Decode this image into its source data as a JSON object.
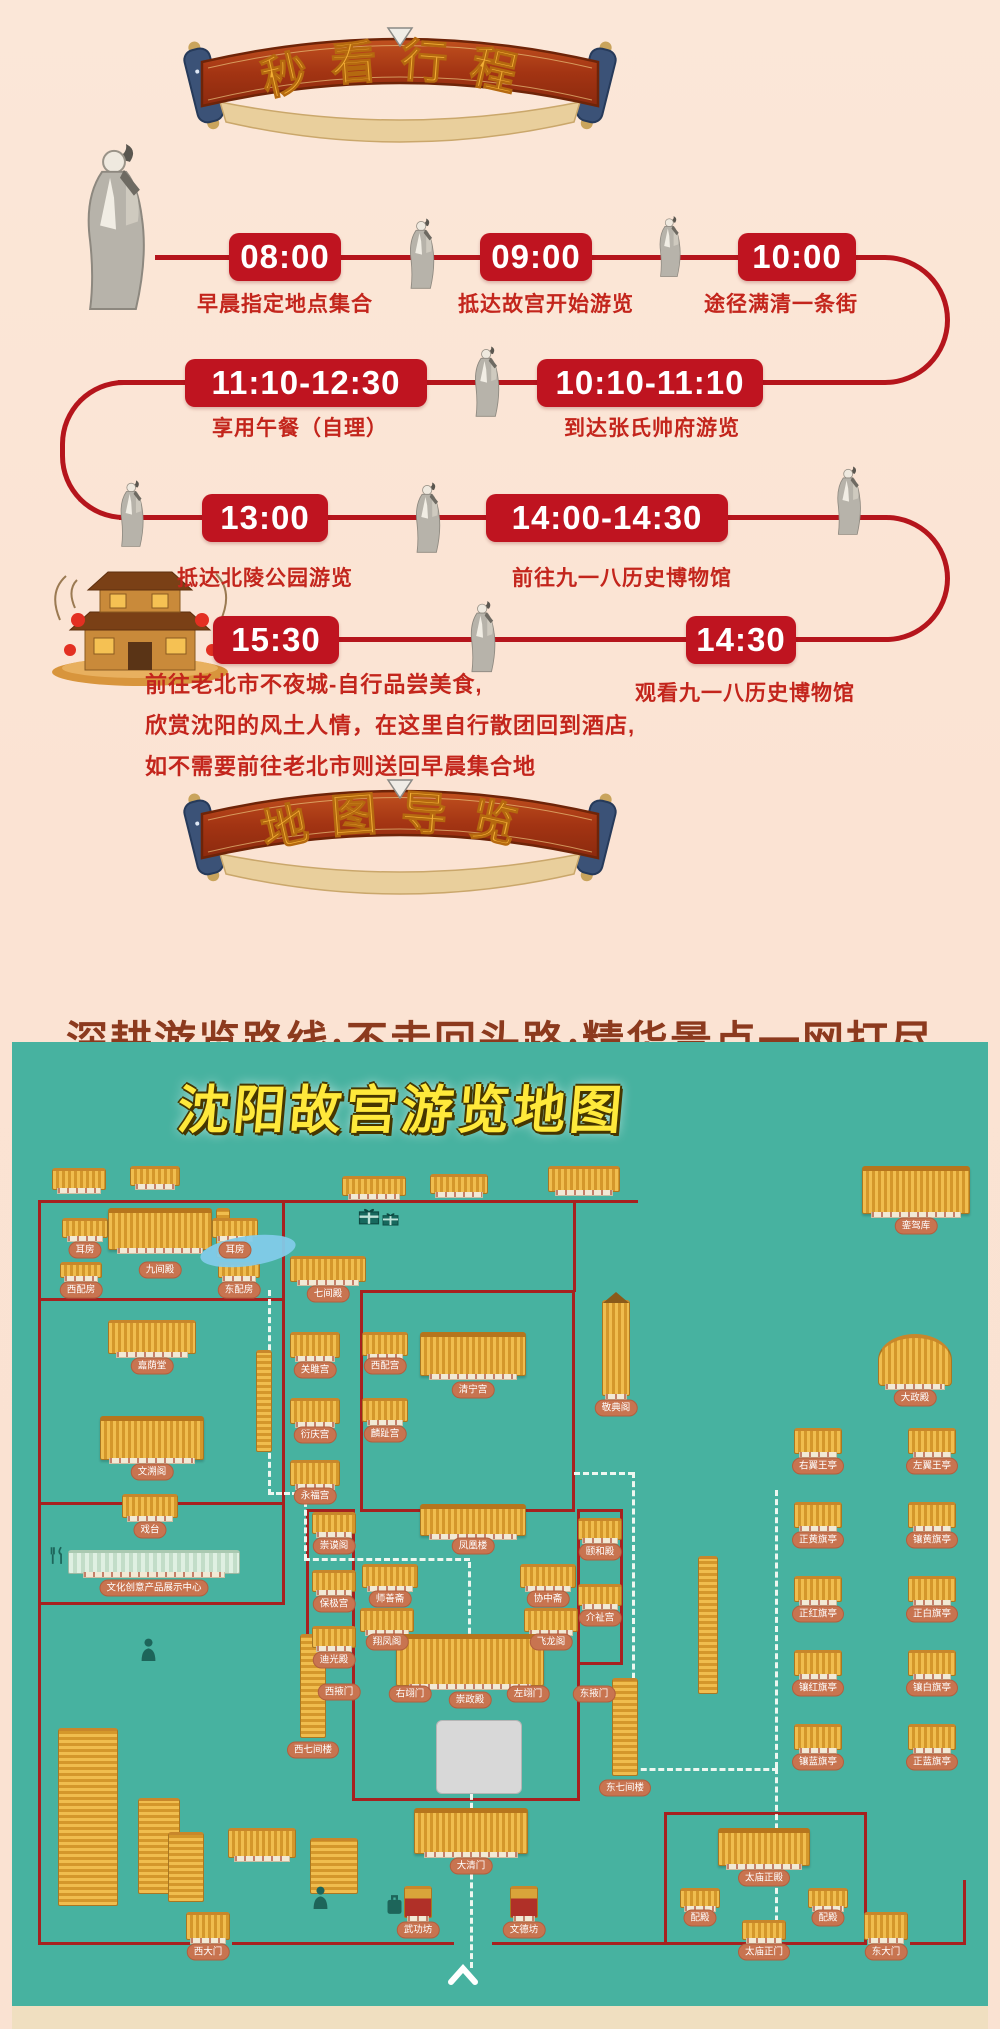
{
  "banners": {
    "itinerary": "秒看行程",
    "map": "地图导览"
  },
  "colors": {
    "page_bg": "#fbe7d8",
    "timeline_red": "#bf1420",
    "desc_red": "#c3251c",
    "tagline_brown": "#8c3a1e",
    "map_teal": "#47b2a0",
    "wall_red": "#a6211f",
    "label_pill": "#c87450",
    "roof_gold": "#e9b54a",
    "title_yellow": "#ffe93b"
  },
  "timeline": {
    "rows": [
      {
        "y": 257,
        "dy": 303,
        "stops": [
          {
            "time": "08:00",
            "cx": 285,
            "w": 112,
            "desc": "早晨指定地点集合",
            "dx": 285
          },
          {
            "time": "09:00",
            "cx": 536,
            "w": 112,
            "desc": "抵达故宫开始游览",
            "dx": 546
          },
          {
            "time": "10:00",
            "cx": 797,
            "w": 118,
            "desc": "途径满清一条街",
            "dx": 781
          }
        ]
      },
      {
        "y": 383,
        "dy": 427,
        "stops": [
          {
            "time": "11:10-12:30",
            "cx": 306,
            "w": 242,
            "desc": "享用午餐（自理）",
            "dx": 300
          },
          {
            "time": "10:10-11:10",
            "cx": 650,
            "w": 226,
            "desc": "到达张氏帅府游览",
            "dx": 652
          }
        ]
      },
      {
        "y": 518,
        "dy": 577,
        "stops": [
          {
            "time": "13:00",
            "cx": 265,
            "w": 126,
            "desc": "抵达北陵公园游览",
            "dx": 265
          },
          {
            "time": "14:00-14:30",
            "cx": 607,
            "w": 242,
            "desc": "前往九一八历史博物馆",
            "dx": 622
          }
        ]
      },
      {
        "y": 640,
        "dy": 692,
        "stops": [
          {
            "time": "15:30",
            "cx": 276,
            "w": 126,
            "desc": "",
            "dx": 0
          },
          {
            "time": "14:30",
            "cx": 741,
            "w": 110,
            "desc": "观看九一八历史博物馆",
            "dx": 745
          }
        ]
      }
    ],
    "final_note_lines": "前往老北市不夜城-自行品尝美食,\n欣赏沈阳的风土人情，在这里自行散团回到酒店,\n如不需要前往老北市则送回早晨集合地"
  },
  "tagline": "深耕游览路线·不走回头路·精华景点一网打尽",
  "map": {
    "title": "沈阳故宫游览地图",
    "walls": [
      [
        26,
        158,
        600,
        3
      ],
      [
        26,
        158,
        3,
        745
      ],
      [
        270,
        158,
        3,
        404
      ],
      [
        26,
        256,
        247,
        3
      ],
      [
        26,
        460,
        247,
        3
      ],
      [
        26,
        560,
        247,
        3
      ],
      [
        348,
        248,
        215,
        3
      ],
      [
        348,
        248,
        3,
        222
      ],
      [
        560,
        248,
        3,
        222
      ],
      [
        348,
        467,
        215,
        3
      ],
      [
        340,
        467,
        3,
        292
      ],
      [
        565,
        467,
        3,
        292
      ],
      [
        340,
        756,
        228,
        3
      ],
      [
        294,
        467,
        49,
        3
      ],
      [
        294,
        467,
        3,
        156
      ],
      [
        294,
        620,
        49,
        3
      ],
      [
        565,
        467,
        46,
        3
      ],
      [
        608,
        467,
        3,
        156
      ],
      [
        565,
        620,
        46,
        3
      ],
      [
        561,
        158,
        3,
        92
      ],
      [
        652,
        770,
        3,
        133
      ],
      [
        852,
        770,
        3,
        133
      ],
      [
        652,
        770,
        203,
        3
      ],
      [
        26,
        900,
        152,
        3
      ],
      [
        220,
        900,
        222,
        3
      ],
      [
        480,
        900,
        174,
        3
      ],
      [
        652,
        900,
        203,
        3
      ],
      [
        898,
        900,
        56,
        3
      ],
      [
        951,
        838,
        3,
        65
      ]
    ],
    "paths": [
      [
        256,
        248,
        "v",
        205
      ],
      [
        256,
        450,
        "h",
        38
      ],
      [
        292,
        450,
        "v",
        68
      ],
      [
        292,
        516,
        "h",
        166
      ],
      [
        456,
        520,
        "v",
        100
      ],
      [
        458,
        690,
        "v",
        236
      ],
      [
        562,
        430,
        "h",
        60
      ],
      [
        620,
        430,
        "v",
        298
      ],
      [
        620,
        726,
        "h",
        146
      ],
      [
        763,
        448,
        "v",
        278
      ],
      [
        763,
        726,
        "v",
        172
      ]
    ],
    "buildings": [
      {
        "x": 40,
        "y": 126,
        "w": 54,
        "h": 22
      },
      {
        "x": 118,
        "y": 124,
        "w": 50,
        "h": 20
      },
      {
        "x": 330,
        "y": 134,
        "w": 64,
        "h": 20
      },
      {
        "x": 418,
        "y": 132,
        "w": 58,
        "h": 20
      },
      {
        "x": 536,
        "y": 124,
        "w": 72,
        "h": 26
      },
      {
        "x": 204,
        "y": 166,
        "w": 14,
        "h": 50,
        "t": "vlong"
      },
      {
        "x": 244,
        "y": 308,
        "w": 16,
        "h": 102,
        "t": "vlong"
      },
      {
        "x": 50,
        "y": 176,
        "w": 46,
        "h": 20,
        "l": "耳房",
        "ly": 208
      },
      {
        "x": 96,
        "y": 166,
        "w": 104,
        "h": 42,
        "t": "big",
        "l": "九间殿",
        "ly": 228
      },
      {
        "x": 200,
        "y": 176,
        "w": 46,
        "h": 20,
        "l": "耳房",
        "ly": 208
      },
      {
        "x": 48,
        "y": 220,
        "w": 42,
        "h": 16,
        "l": "西配房",
        "ly": 248
      },
      {
        "x": 206,
        "y": 220,
        "w": 42,
        "h": 16,
        "l": "东配房",
        "ly": 248
      },
      {
        "x": 96,
        "y": 278,
        "w": 88,
        "h": 34,
        "l": "嘉荫堂"
      },
      {
        "x": 88,
        "y": 374,
        "w": 104,
        "h": 44,
        "t": "big",
        "l": "文溯阁"
      },
      {
        "x": 110,
        "y": 452,
        "w": 56,
        "h": 24,
        "l": "戏台"
      },
      {
        "x": 56,
        "y": 508,
        "w": 172,
        "h": 24,
        "t": "pale",
        "l": "文化创意产品展示中心",
        "ly": 546
      },
      {
        "x": 288,
        "y": 592,
        "w": 26,
        "h": 104,
        "t": "vlong",
        "l": "西七间楼",
        "ly": 708
      },
      {
        "x": 300,
        "y": 470,
        "w": 44,
        "h": 22,
        "l": "崇谟阁"
      },
      {
        "x": 300,
        "y": 528,
        "w": 44,
        "h": 22,
        "l": "保极宫"
      },
      {
        "x": 300,
        "y": 584,
        "w": 44,
        "h": 22,
        "l": "迪光殿"
      },
      {
        "l": "西掖门",
        "lx": 327,
        "ly": 650
      },
      {
        "x": 278,
        "y": 214,
        "w": 76,
        "h": 26,
        "l": "七间殿",
        "ly": 252
      },
      {
        "x": 278,
        "y": 290,
        "w": 50,
        "h": 26,
        "l": "关雎宫",
        "ly": 328
      },
      {
        "x": 350,
        "y": 290,
        "w": 46,
        "h": 24,
        "l": "西配宫",
        "ly": 324
      },
      {
        "x": 408,
        "y": 290,
        "w": 106,
        "h": 44,
        "t": "big",
        "l": "清宁宫",
        "ly": 348
      },
      {
        "x": 278,
        "y": 356,
        "w": 50,
        "h": 26,
        "l": "衍庆宫",
        "ly": 393
      },
      {
        "x": 350,
        "y": 356,
        "w": 46,
        "h": 24,
        "l": "麟趾宫",
        "ly": 392
      },
      {
        "x": 278,
        "y": 418,
        "w": 50,
        "h": 26,
        "l": "永福宫",
        "ly": 454
      },
      {
        "x": 408,
        "y": 462,
        "w": 106,
        "h": 32,
        "t": "big",
        "l": "凤凰楼",
        "ly": 504
      },
      {
        "x": 350,
        "y": 522,
        "w": 56,
        "h": 24,
        "l": "师善斋",
        "ly": 557
      },
      {
        "x": 508,
        "y": 522,
        "w": 56,
        "h": 24,
        "l": "协中斋",
        "ly": 557
      },
      {
        "x": 348,
        "y": 566,
        "w": 54,
        "h": 24,
        "l": "翔凤阁",
        "ly": 600
      },
      {
        "x": 512,
        "y": 566,
        "w": 54,
        "h": 24,
        "l": "飞龙阁",
        "ly": 600
      },
      {
        "x": 384,
        "y": 592,
        "w": 148,
        "h": 52,
        "t": "big",
        "l": "崇政殿",
        "ly": 658
      },
      {
        "l": "右翊门",
        "lx": 398,
        "ly": 652
      },
      {
        "l": "左翊门",
        "lx": 516,
        "ly": 652
      },
      {
        "l": "东掖门",
        "lx": 582,
        "ly": 652
      },
      {
        "x": 424,
        "y": 678,
        "w": 86,
        "h": 74,
        "t": "plaza"
      },
      {
        "x": 402,
        "y": 766,
        "w": 114,
        "h": 46,
        "t": "big",
        "l": "大清门",
        "ly": 824
      },
      {
        "x": 392,
        "y": 844,
        "w": 28,
        "h": 32,
        "t": "paifang",
        "l": "武功坊",
        "ly": 888
      },
      {
        "x": 498,
        "y": 844,
        "w": 28,
        "h": 32,
        "t": "paifang",
        "l": "文德坊",
        "ly": 888
      },
      {
        "x": 590,
        "y": 258,
        "w": 28,
        "h": 96,
        "t": "tower",
        "l": "敬典阁",
        "ly": 366
      },
      {
        "x": 566,
        "y": 476,
        "w": 44,
        "h": 22,
        "l": "颐和殿",
        "ly": 510
      },
      {
        "x": 566,
        "y": 542,
        "w": 44,
        "h": 22,
        "l": "介祉宫",
        "ly": 576
      },
      {
        "x": 600,
        "y": 636,
        "w": 26,
        "h": 98,
        "t": "vlong",
        "l": "东七间楼",
        "ly": 746
      },
      {
        "x": 850,
        "y": 124,
        "w": 108,
        "h": 48,
        "t": "big",
        "l": "銮驾库",
        "ly": 184
      },
      {
        "x": 866,
        "y": 292,
        "w": 74,
        "h": 52,
        "t": "dazheng",
        "l": "大政殿",
        "ly": 356
      },
      {
        "x": 782,
        "y": 386,
        "w": 48,
        "h": 26,
        "l": "右翼王亭",
        "ly": 424
      },
      {
        "x": 896,
        "y": 386,
        "w": 48,
        "h": 26,
        "l": "左翼王亭",
        "ly": 424
      },
      {
        "x": 782,
        "y": 460,
        "w": 48,
        "h": 26,
        "l": "正黄旗亭",
        "ly": 498
      },
      {
        "x": 896,
        "y": 460,
        "w": 48,
        "h": 26,
        "l": "镶黄旗亭",
        "ly": 498
      },
      {
        "x": 782,
        "y": 534,
        "w": 48,
        "h": 26,
        "l": "正红旗亭",
        "ly": 572
      },
      {
        "x": 896,
        "y": 534,
        "w": 48,
        "h": 26,
        "l": "正白旗亭",
        "ly": 572
      },
      {
        "x": 782,
        "y": 608,
        "w": 48,
        "h": 26,
        "l": "镶红旗亭",
        "ly": 646
      },
      {
        "x": 896,
        "y": 608,
        "w": 48,
        "h": 26,
        "l": "镶白旗亭",
        "ly": 646
      },
      {
        "x": 782,
        "y": 682,
        "w": 48,
        "h": 26,
        "l": "镶蓝旗亭",
        "ly": 720
      },
      {
        "x": 896,
        "y": 682,
        "w": 48,
        "h": 26,
        "l": "正蓝旗亭",
        "ly": 720
      },
      {
        "x": 686,
        "y": 514,
        "w": 20,
        "h": 138,
        "t": "vlong"
      },
      {
        "x": 706,
        "y": 786,
        "w": 92,
        "h": 38,
        "t": "big",
        "l": "太庙正殿",
        "ly": 836
      },
      {
        "x": 668,
        "y": 846,
        "w": 40,
        "h": 20,
        "l": "配殿",
        "ly": 876
      },
      {
        "x": 796,
        "y": 846,
        "w": 40,
        "h": 20,
        "l": "配殿",
        "ly": 876
      },
      {
        "x": 730,
        "y": 878,
        "w": 44,
        "h": 20,
        "l": "太庙正门",
        "ly": 910
      },
      {
        "x": 174,
        "y": 870,
        "w": 44,
        "h": 28,
        "l": "西大门",
        "ly": 910
      },
      {
        "x": 852,
        "y": 870,
        "w": 44,
        "h": 28,
        "l": "东大门",
        "ly": 910
      },
      {
        "x": 46,
        "y": 686,
        "w": 60,
        "h": 178,
        "t": "vlong"
      },
      {
        "x": 126,
        "y": 756,
        "w": 42,
        "h": 96,
        "t": "vlong"
      },
      {
        "x": 156,
        "y": 790,
        "w": 36,
        "h": 70,
        "t": "vlong"
      },
      {
        "x": 216,
        "y": 786,
        "w": 68,
        "h": 30
      },
      {
        "x": 298,
        "y": 796,
        "w": 48,
        "h": 56,
        "t": "vlong"
      }
    ],
    "icons": [
      {
        "t": "pond",
        "x": 188,
        "y": 194,
        "w": 96,
        "h": 30
      },
      {
        "t": "gift",
        "x": 346,
        "y": 164,
        "w": 22,
        "h": 19
      },
      {
        "t": "gift",
        "x": 370,
        "y": 169,
        "w": 17,
        "h": 15
      },
      {
        "t": "person",
        "x": 128,
        "y": 596,
        "w": 17,
        "h": 23
      },
      {
        "t": "person",
        "x": 300,
        "y": 844,
        "w": 17,
        "h": 23
      },
      {
        "t": "luggage",
        "x": 374,
        "y": 852,
        "w": 17,
        "h": 21
      },
      {
        "t": "chevron",
        "x": 436,
        "y": 922,
        "w": 30,
        "h": 21
      },
      {
        "t": "dining",
        "x": 36,
        "y": 504,
        "w": 19,
        "h": 19
      }
    ]
  }
}
